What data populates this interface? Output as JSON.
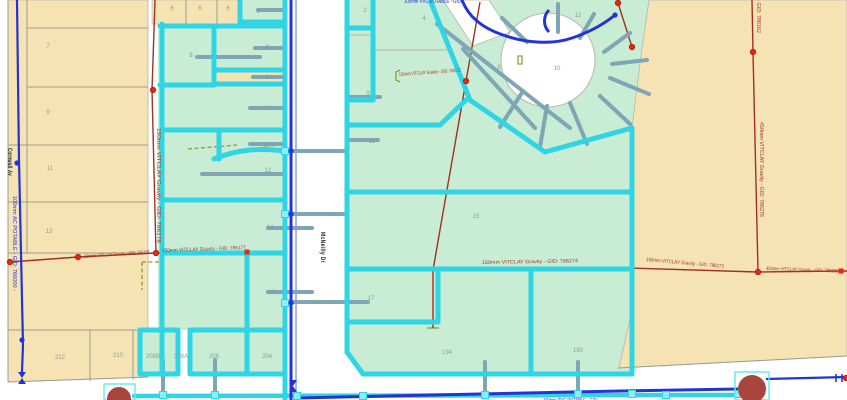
{
  "map": {
    "street_labels": [
      {
        "name": "Cornwall Av",
        "x": 8,
        "y": 148,
        "rot": 90,
        "len": 28
      },
      {
        "name": "McNeilly Dr",
        "x": 321,
        "y": 232,
        "rot": 90,
        "len": 31
      }
    ],
    "parcel_labels": [
      {
        "text": "7",
        "x": 48,
        "y": 48
      },
      {
        "text": "9",
        "x": 48,
        "y": 114
      },
      {
        "text": "11",
        "x": 50,
        "y": 170
      },
      {
        "text": "13",
        "x": 49,
        "y": 233
      },
      {
        "text": "212",
        "x": 60,
        "y": 359
      },
      {
        "text": "210",
        "x": 118,
        "y": 357
      },
      {
        "text": "6",
        "x": 172,
        "y": 10
      },
      {
        "text": "6",
        "x": 200,
        "y": 10
      },
      {
        "text": "6",
        "x": 228,
        "y": 10
      },
      {
        "text": "6",
        "x": 258,
        "y": 13
      },
      {
        "text": "8",
        "x": 191,
        "y": 57
      },
      {
        "text": "8",
        "x": 267,
        "y": 49
      },
      {
        "text": "8",
        "x": 267,
        "y": 79
      },
      {
        "text": "10",
        "x": 268,
        "y": 110
      },
      {
        "text": "12A",
        "x": 268,
        "y": 147
      },
      {
        "text": "12",
        "x": 268,
        "y": 172
      },
      {
        "text": "14",
        "x": 270,
        "y": 229
      },
      {
        "text": "16",
        "x": 272,
        "y": 294
      },
      {
        "text": "208B",
        "x": 153,
        "y": 358
      },
      {
        "text": "208A",
        "x": 181,
        "y": 358
      },
      {
        "text": "206",
        "x": 214,
        "y": 358
      },
      {
        "text": "204",
        "x": 267,
        "y": 358
      },
      {
        "text": "2",
        "x": 365,
        "y": 12
      },
      {
        "text": "4",
        "x": 424,
        "y": 20
      },
      {
        "text": "9",
        "x": 368,
        "y": 95
      },
      {
        "text": "11",
        "x": 372,
        "y": 143
      },
      {
        "text": "8",
        "x": 499,
        "y": 69
      },
      {
        "text": "10",
        "x": 557,
        "y": 70
      },
      {
        "text": "12",
        "x": 578,
        "y": 17
      },
      {
        "text": "15",
        "x": 476,
        "y": 218
      },
      {
        "text": "17",
        "x": 371,
        "y": 300
      },
      {
        "text": "194",
        "x": 447,
        "y": 354
      },
      {
        "text": "190",
        "x": 578,
        "y": 352
      }
    ],
    "pipe_labels": [
      {
        "text": "100mm AC POTABLE - GID: 766000 -",
        "kind": "water",
        "x": 13,
        "y": 196,
        "rot": 90,
        "len": 95
      },
      {
        "text": "100mm PVC POTABLE - GID:",
        "kind": "water",
        "x": 404,
        "y": 3,
        "rot": 0,
        "len": 58
      },
      {
        "text": "100mm PVC POTABLE - GID:",
        "kind": "water",
        "x": 543,
        "y": 402,
        "rot": 0,
        "len": 55
      },
      {
        "text": "150mm VITCLAY Gravity - GID: 786178",
        "kind": "sewer",
        "x": 157,
        "y": 128,
        "rot": 90,
        "len": 115
      },
      {
        "text": "150mm VITCLAY Gravity - GID: 786181",
        "kind": "sewer",
        "x": 84,
        "y": 258,
        "rot": -4,
        "len": 66
      },
      {
        "text": "150mm VITCLAY Gravity - GID: 786177",
        "kind": "sewer",
        "x": 162,
        "y": 252,
        "rot": -2,
        "len": 84
      },
      {
        "text": "150mm VITCLAY Gravity - GID: 786172",
        "kind": "sewer",
        "x": 399,
        "y": 76,
        "rot": -4,
        "len": 62
      },
      {
        "text": "150mm VITCLAY Gravity - GID: 786274",
        "kind": "sewer",
        "x": 482,
        "y": 264,
        "rot": -1,
        "len": 96
      },
      {
        "text": "150mm VITCLAY Gravity - GID: 786273",
        "kind": "sewer",
        "x": 646,
        "y": 261,
        "rot": 5,
        "len": 78
      },
      {
        "text": "450mm VITCLAY Gravity - GID: 786231",
        "kind": "sewer",
        "x": 766,
        "y": 270,
        "rot": 2,
        "len": 72
      },
      {
        "text": "450mm VITCLAY Gravity - GID: 786162",
        "kind": "sewer",
        "x": 757,
        "y": -62,
        "rot": 90,
        "len": 95
      },
      {
        "text": "450mm VITCLAY Gravity - GID: 786276",
        "kind": "sewer",
        "x": 760,
        "y": 122,
        "rot": 90,
        "len": 95
      }
    ],
    "markers": {
      "red_nodes": [
        [
          153,
          90
        ],
        [
          78,
          257
        ],
        [
          10,
          262
        ],
        [
          156,
          253
        ],
        [
          466,
          81
        ],
        [
          753,
          52
        ],
        [
          758,
          272
        ],
        [
          618,
          3
        ],
        [
          632,
          47
        ],
        [
          846,
          378
        ]
      ],
      "red_squares": [
        [
          247,
          252
        ],
        [
          841,
          271
        ]
      ],
      "blue_dots": [
        [
          17,
          163
        ],
        [
          22,
          340
        ],
        [
          291,
          151
        ],
        [
          291,
          214
        ],
        [
          291,
          303
        ],
        [
          615,
          15
        ]
      ],
      "teal_nodes": [
        [
          163,
          395
        ],
        [
          215,
          395
        ],
        [
          297,
          396
        ],
        [
          363,
          396
        ],
        [
          485,
          395
        ],
        [
          578,
          394
        ],
        [
          632,
          394
        ],
        [
          666,
          395
        ],
        [
          738,
          394
        ],
        [
          285,
          151
        ],
        [
          285,
          214
        ],
        [
          285,
          303
        ]
      ],
      "valves": [
        [
          22,
          378
        ],
        [
          293,
          386
        ]
      ],
      "valve_ticks": [
        [
          836,
          378
        ],
        [
          842,
          378
        ]
      ],
      "pumps": [
        {
          "cx": 119,
          "cy": 399,
          "r": 12,
          "box": [
            104,
            384,
            31,
            16
          ]
        },
        {
          "cx": 752,
          "cy": 389,
          "r": 14,
          "box": [
            735,
            372,
            34,
            28
          ]
        }
      ]
    },
    "colors": {
      "parcel_tan": "#f6e3b4",
      "parcel_green": "#c9ecd4",
      "road": "#ffffff",
      "boundary_gray": "#9c9c94",
      "water_main_blue": "#2334d6",
      "water_service_teal": "#2fd5e5",
      "service_stub_steel": "#7fa6b4",
      "sewer_red": "#a03122",
      "node_red": "#ee2413",
      "easement_olive": "#8f9a33",
      "pump_marker": "#a8453c",
      "parcel_label": "#8d9c94"
    }
  }
}
